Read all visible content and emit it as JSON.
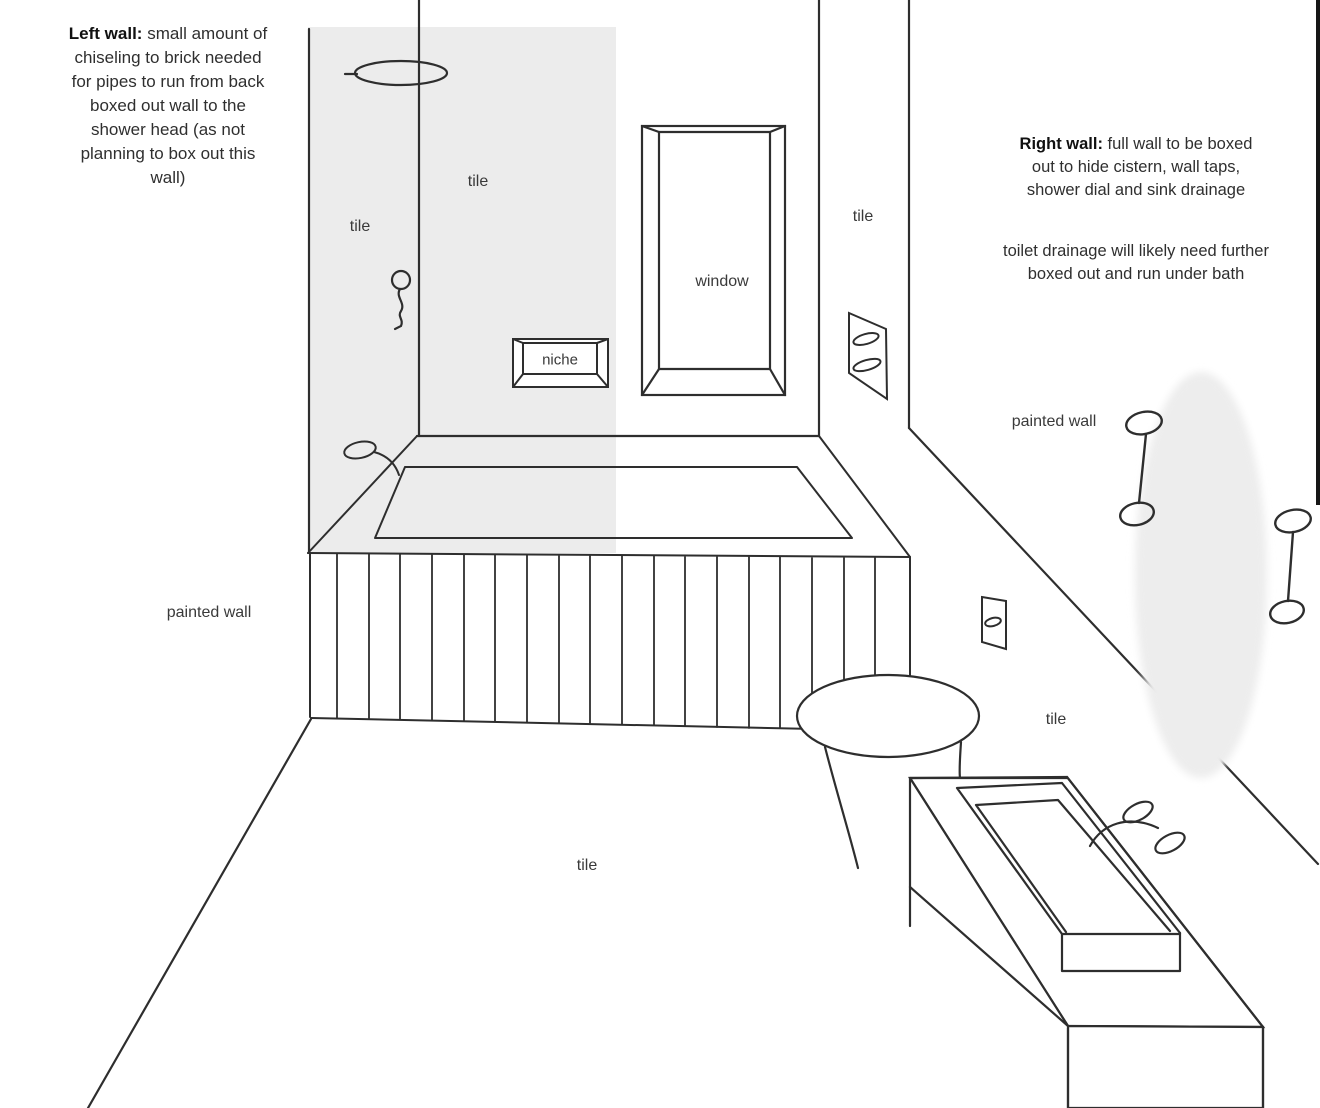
{
  "annotations": {
    "left_wall": {
      "lead": "Left wall:",
      "body": [
        " small amount of",
        "chiseling to brick needed",
        "for pipes to run from back",
        "boxed out wall to the",
        "shower head (as not",
        "planning to box out this",
        "wall)"
      ]
    },
    "right_wall": {
      "lead": "Right wall:",
      "body": [
        " full wall to be boxed",
        "out to hide cistern, wall taps,",
        "shower dial and sink drainage"
      ],
      "para2": [
        "toilet drainage will likely need further",
        "boxed out and run under bath"
      ]
    }
  },
  "labels": {
    "tile_shower_wall": "tile",
    "tile_left_wall": "tile",
    "window": "window",
    "niche": "niche",
    "tile_right_wall_upper": "tile",
    "painted_wall_right": "painted wall",
    "tile_right_wall_lower": "tile",
    "painted_wall_left": "painted wall",
    "tile_floor": "tile"
  },
  "colors": {
    "ink": "#2e2e2e",
    "tile_shade": "rgba(0,0,0,0.075)",
    "highlight_blob": "#ededed",
    "background": "#ffffff",
    "screen_edge": "#161616"
  }
}
